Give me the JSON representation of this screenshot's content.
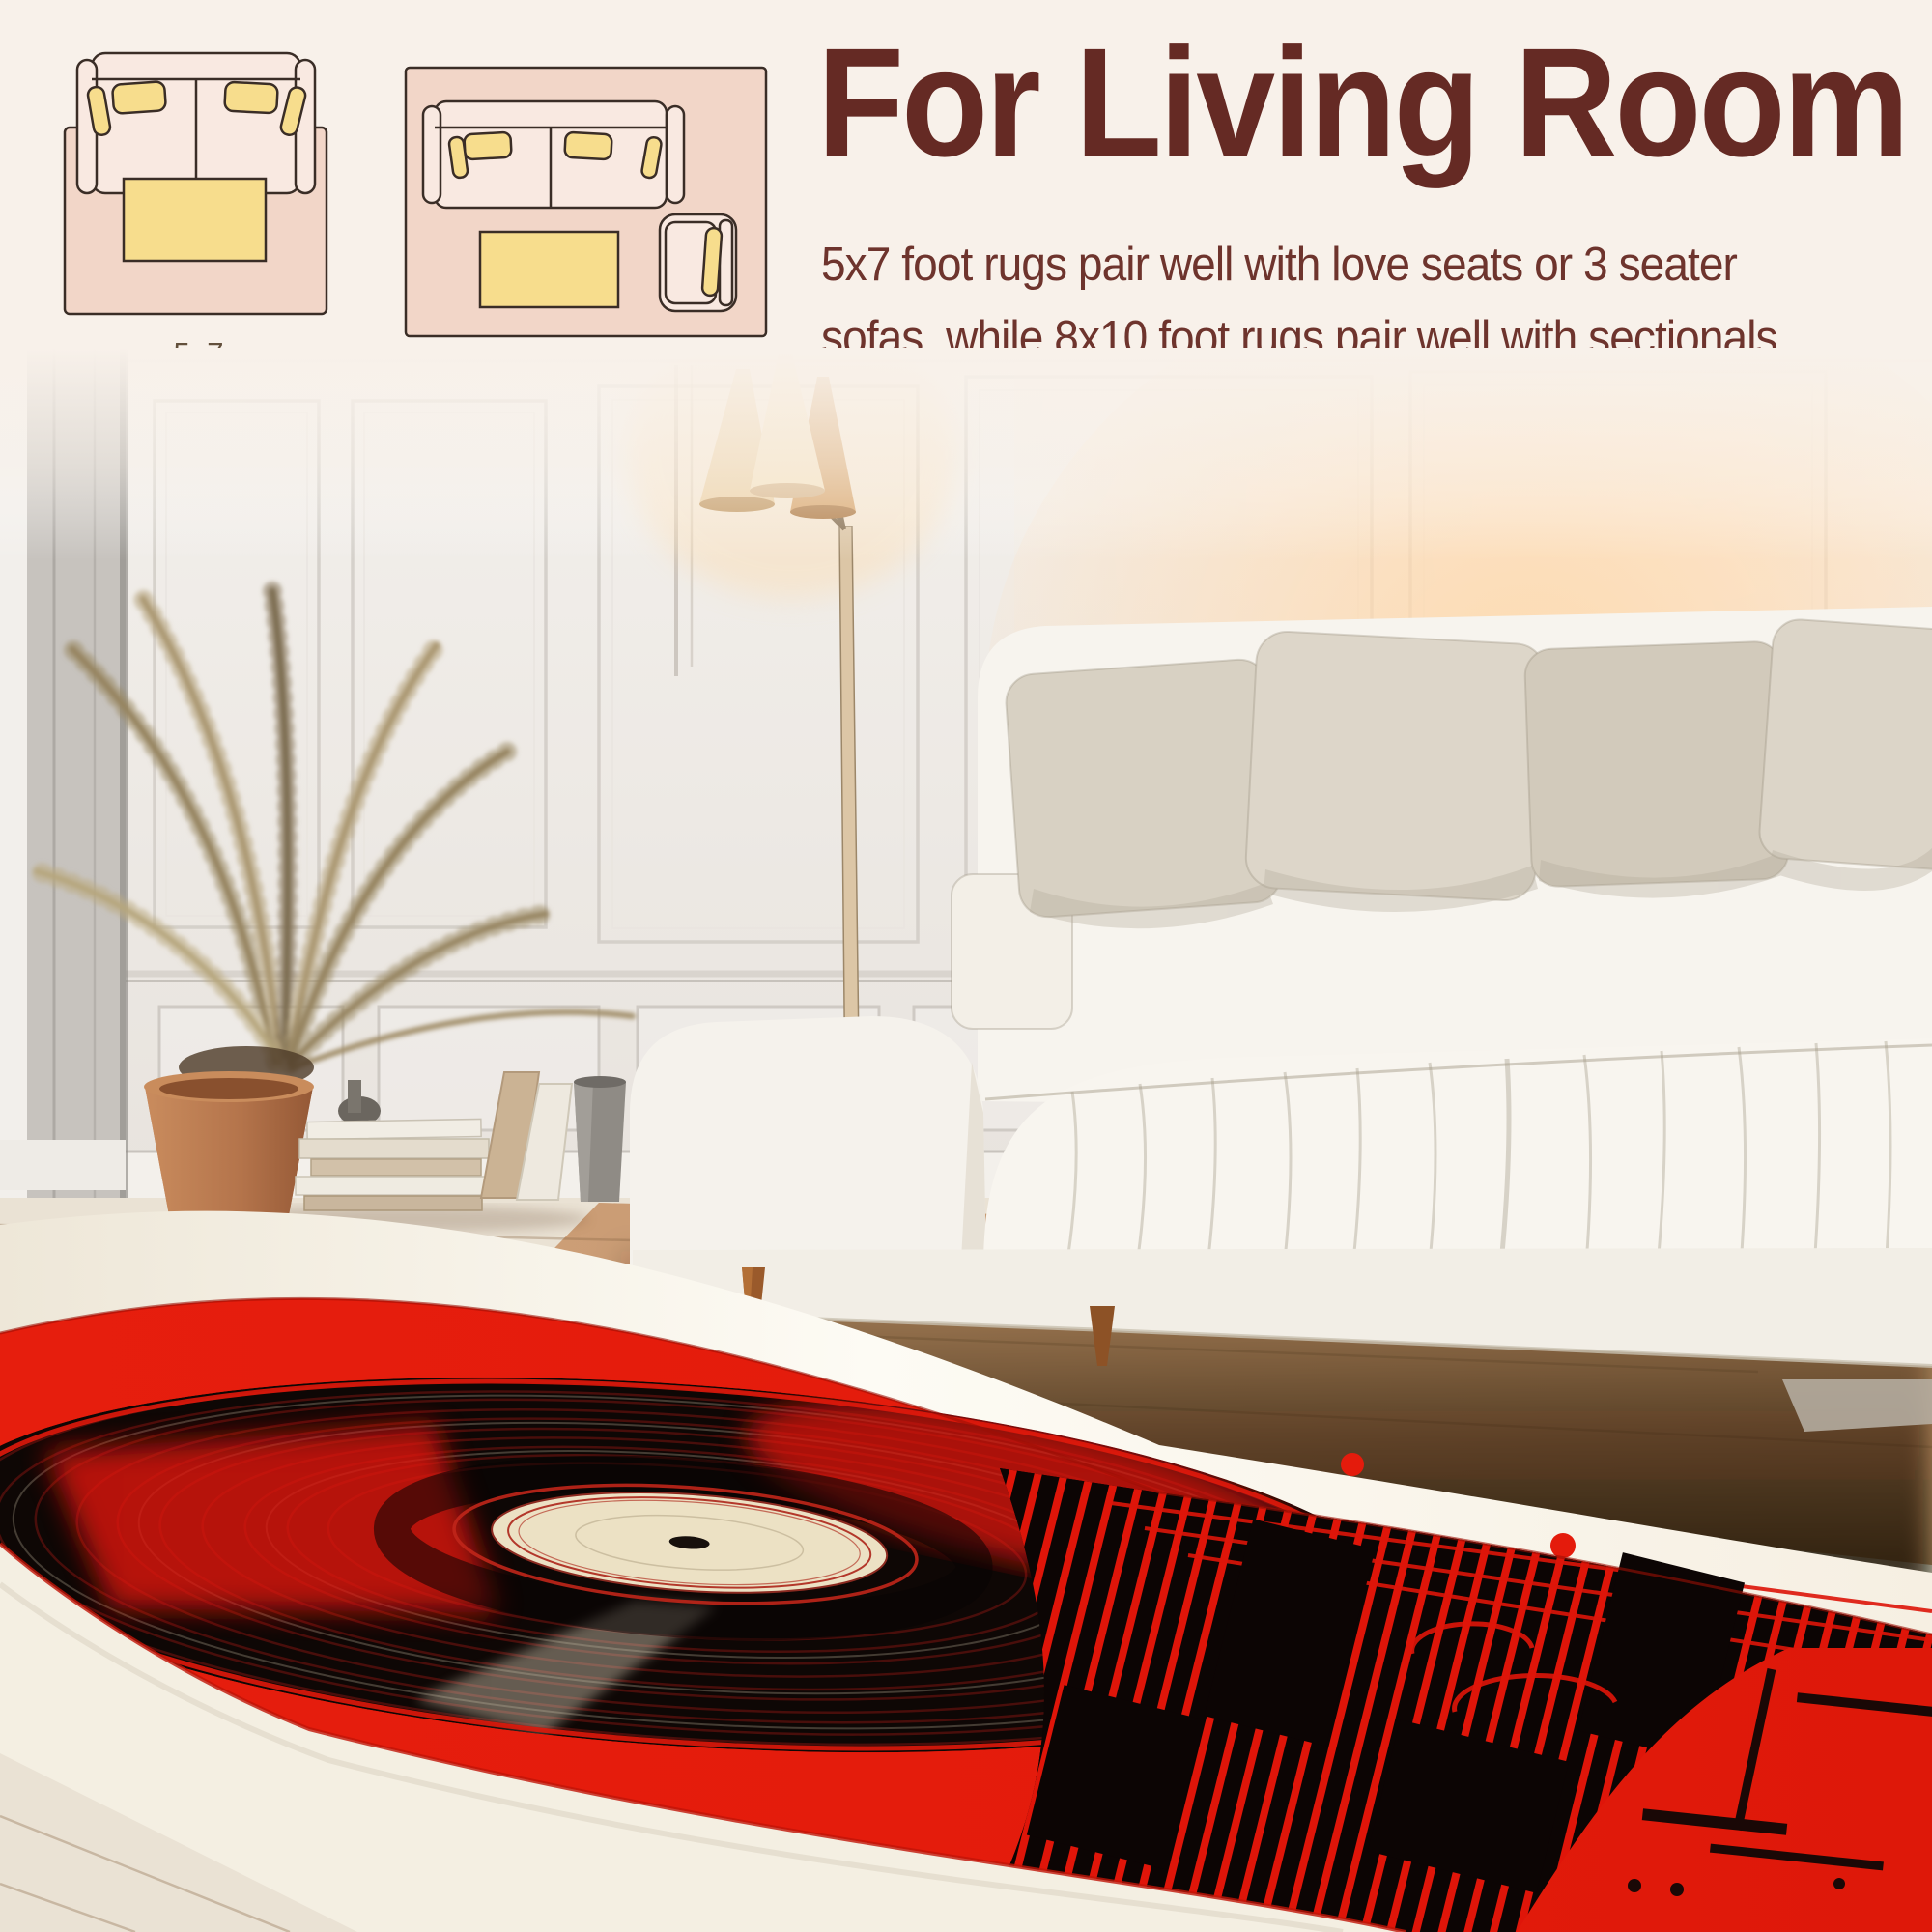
{
  "header": {
    "title": "For Living Room",
    "description_line1": "5x7 foot rugs pair well with love seats or 3 seater",
    "description_line2": "sofas, while 8x10 foot rugs pair well with sectionals.",
    "text_color": "#652a24"
  },
  "size_diagrams": {
    "label_color": "#63503c",
    "items": [
      {
        "label": "5x7"
      },
      {
        "label": "8x10"
      }
    ],
    "colors": {
      "rug": "#f2d6c8",
      "sofa": "#f9e9e1",
      "furniture_accent": "#f7dd8d",
      "outline": "#3a2d26"
    }
  },
  "scene": {
    "rug_colors": {
      "field_red": "#e41b0c",
      "record_black": "#0e0705",
      "label_cream": "#ece1c4",
      "border_cream": "#f4efe2"
    },
    "room_colors": {
      "wall": "#efece8",
      "floor_white": "#eae2d4",
      "floor_wood": "#c8986f",
      "sofa": "#f7f4ee",
      "pillow": "#d8d1c3",
      "pot_terracotta": "#b4744b",
      "lamp_shade": "#f4e0bd"
    }
  }
}
